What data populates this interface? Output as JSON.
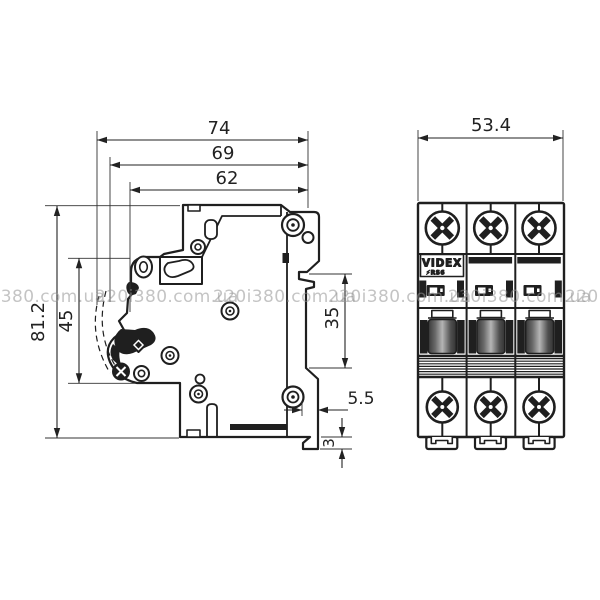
{
  "page": {
    "background": "#ffffff",
    "line_color": "#1f1f1f"
  },
  "watermark": {
    "text": "220i380.com.ua",
    "color": "#949494"
  },
  "drawing": {
    "type": "technical-drawing",
    "subject": "3-pole modular circuit breaker, side and front projections",
    "colors": {
      "outline": "#1f1f1f",
      "dimension": "#222222",
      "toggle_dark": "#383838",
      "toggle_light": "#b5b5b5"
    },
    "views": {
      "side": {
        "name": "side view",
        "dimensions": {
          "width_total": "74",
          "width_upper": "69",
          "width_face": "62",
          "height_total": "81.2",
          "height_front": "45",
          "din_rail_span": "35",
          "clip_offset": "5.5",
          "clip_height": "3"
        }
      },
      "front": {
        "name": "front view",
        "poles": 3,
        "dimensions": {
          "width_total": "53.4"
        },
        "brand": "VIDEX",
        "model": "⚡RS6"
      }
    }
  }
}
